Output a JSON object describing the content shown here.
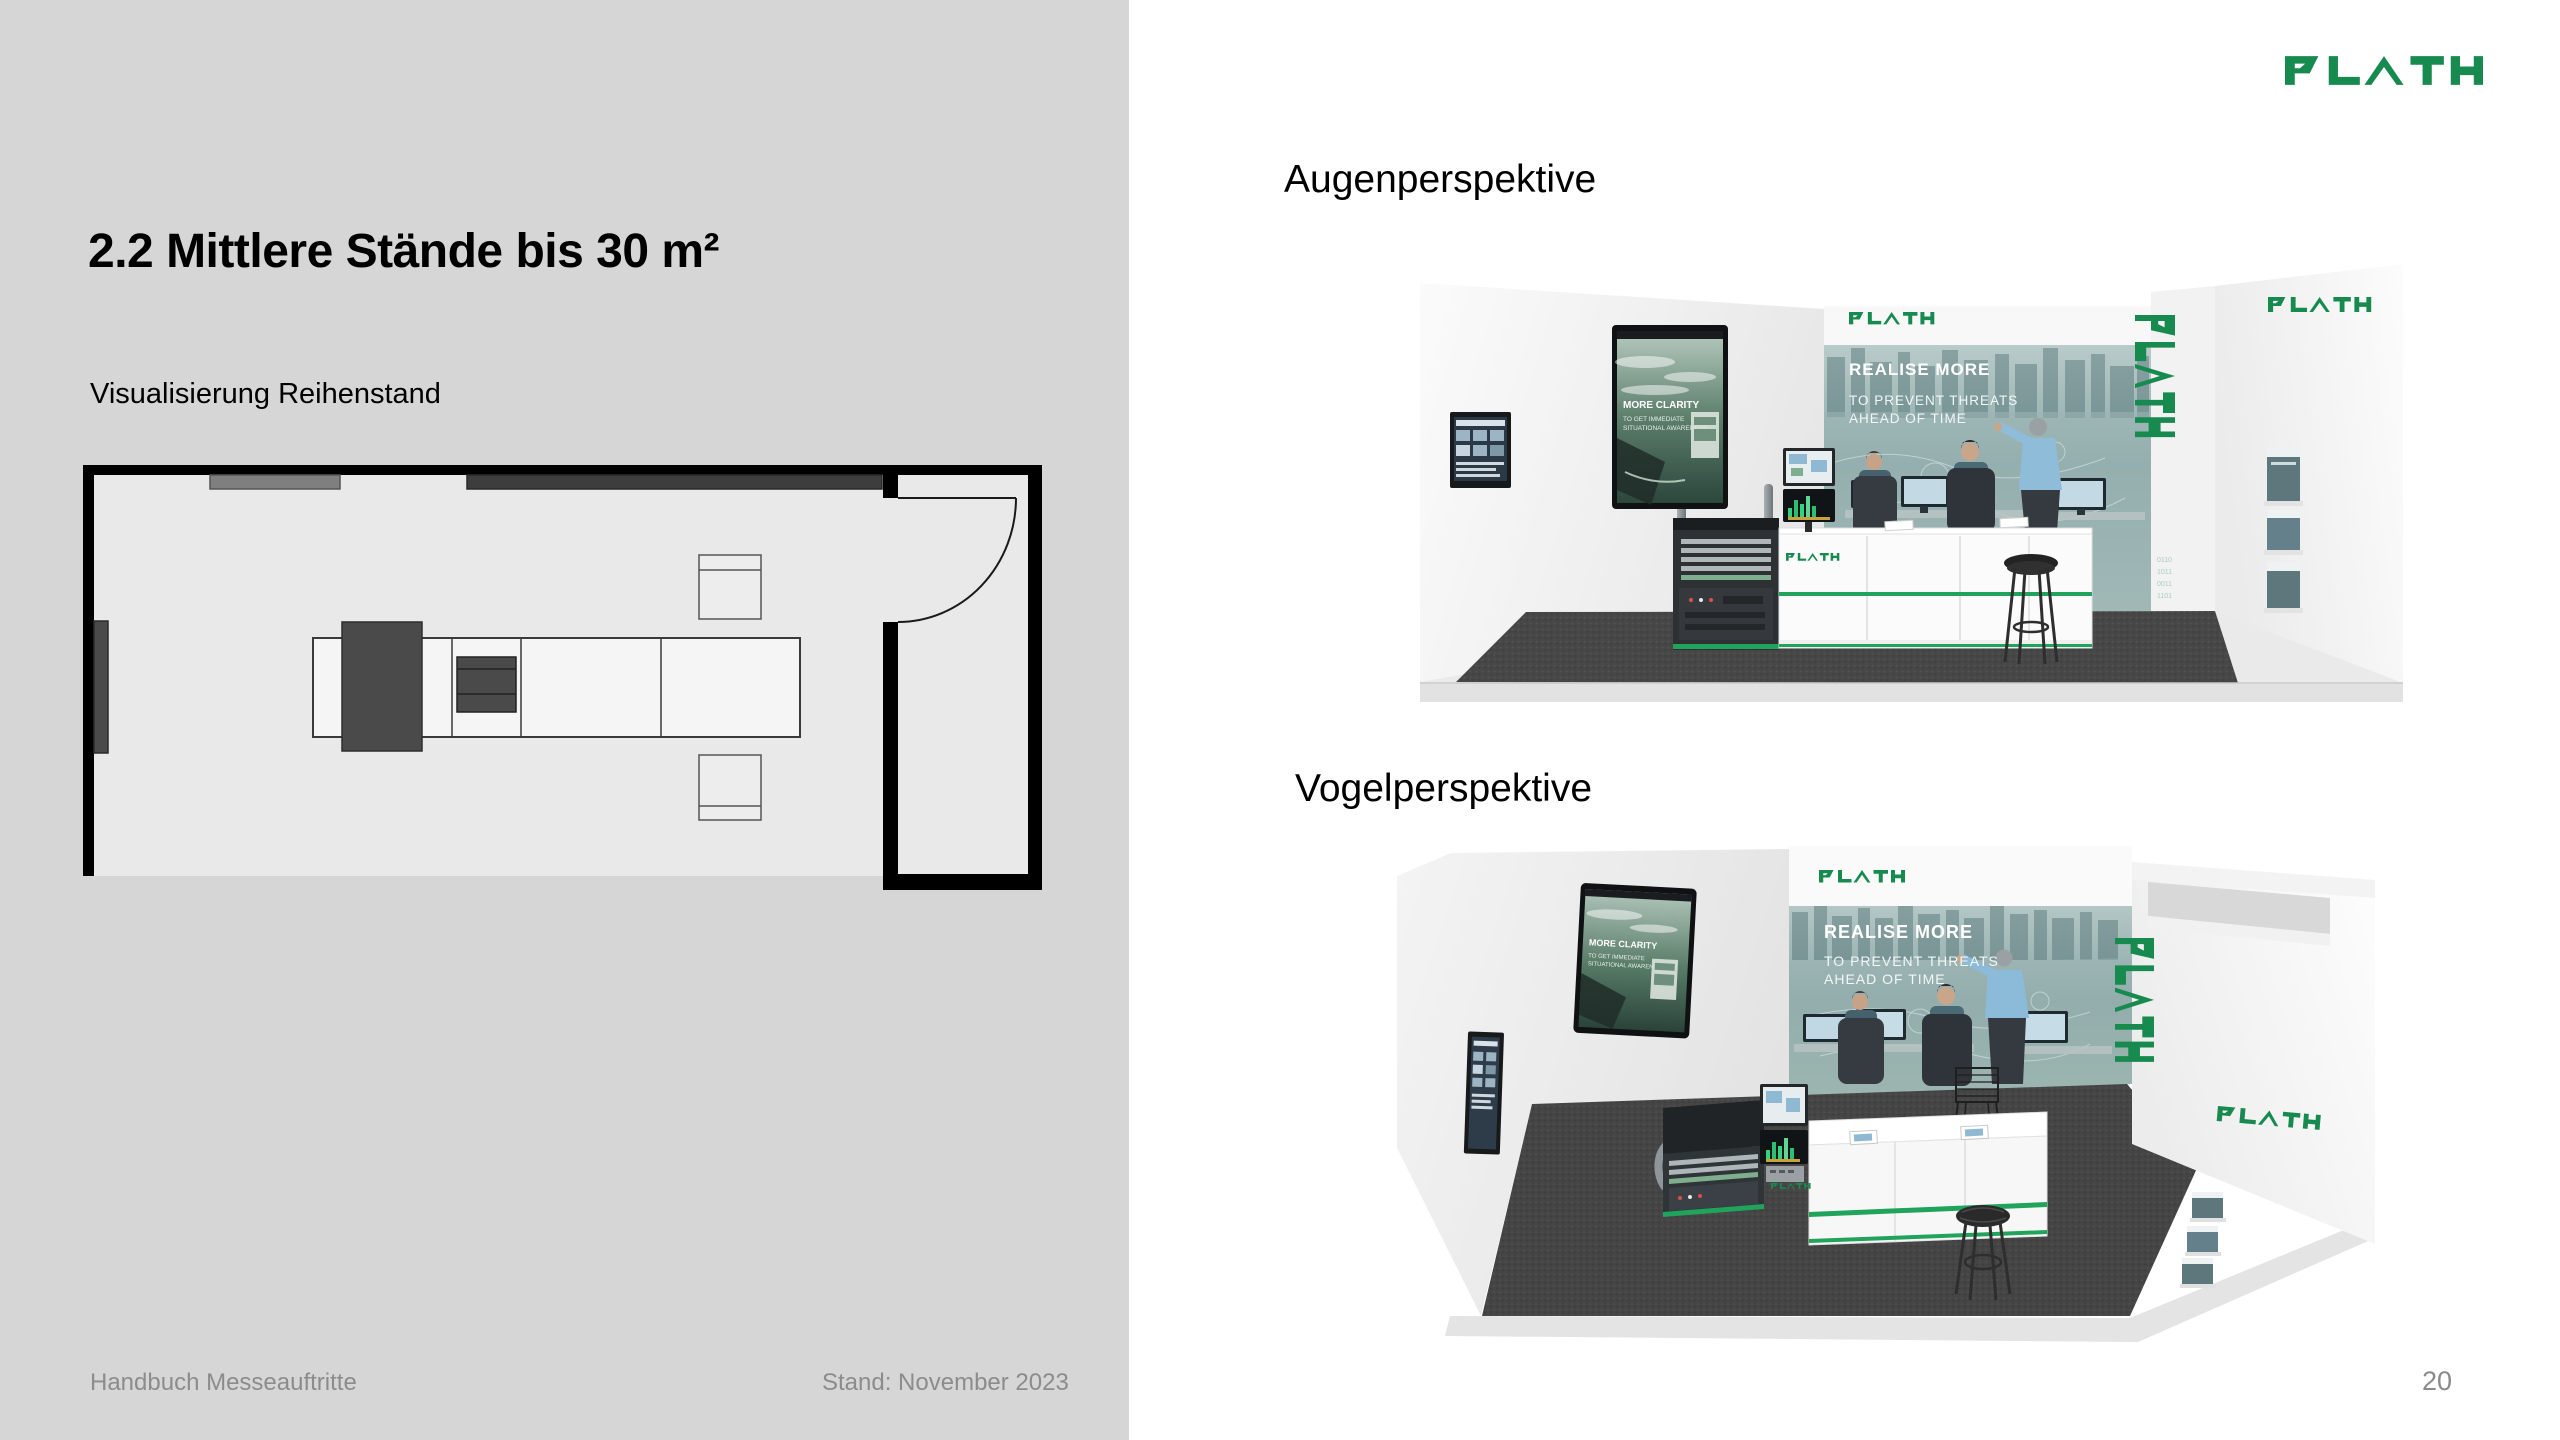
{
  "slide": {
    "title": "2.2 Mittlere Stände bis 30 m²",
    "subtitle": "Visualisierung Reihenstand",
    "footer_left": "Handbuch Messeauftritte",
    "footer_right": "Stand: November 2023",
    "page_number": "20",
    "brand": "PLATH"
  },
  "views": {
    "eye_label": "Augenperspektive",
    "bird_label": "Vogelperspektive"
  },
  "booth": {
    "backwall_logo": "PLATH",
    "headline": "REALISE MORE",
    "subline1": "TO PREVENT THREATS",
    "subline2": "AHEAD OF TIME",
    "display_title": "MORE CLARITY",
    "display_line1": "TO GET IMMEDIATE",
    "display_line2": "SITUATIONAL AWARENESS",
    "counter_logo": "PLATH",
    "pillar_logo": "PLATH",
    "sidewall_logo": "PLATH"
  },
  "colors": {
    "brand_green": "#178A4F",
    "accent_green": "#20A45B",
    "panel_gray": "#D6D6D6",
    "plan_floor": "#E9E9E9",
    "carpet_dark": "#474747",
    "footer_gray": "#8C8C8C"
  }
}
